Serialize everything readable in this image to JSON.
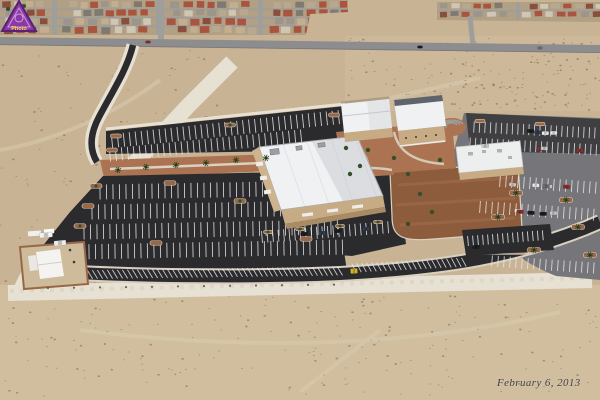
{
  "image_type": "oblique-aerial-photograph",
  "watermark": {
    "label": "Photo",
    "triangle_fill": "#8a3aa5",
    "triangle_edge": "#5a2172",
    "inner_ring": "#d9b0e8",
    "text_color": "#ffd84a"
  },
  "caption": {
    "date_text": "February 6, 2013",
    "color": "#3f3f49"
  },
  "palette": {
    "desert": "#c8b394",
    "desert_light": "#d6c4a5",
    "residential_base": "#b2a084",
    "street": "#9e9e9c",
    "road": "#8d8d90",
    "road_edge": "#6e6e71",
    "asphalt_new": "#2b2b2e",
    "asphalt_old": "#76767a",
    "asphalt_north": "#3f3f42",
    "gravel": "#e7e1d3",
    "gravel_inner": "#d8d0c0",
    "dirt_field": "#8d5c3d",
    "dirt_field_light": "#9d6a4a",
    "courtyard": "#ab7351",
    "roof_white": "#f0f1f3",
    "roof_shade": "#dcdde0",
    "wall_tan": "#c6ab85",
    "wall_tan_dark": "#a98c66",
    "curb": "#d9d2c3",
    "island": "#9b6847",
    "stripe": "#e9e9ea",
    "notch_stripe": "#eef4f6",
    "tree": "#33502b",
    "palm": "#2c451f",
    "shrub": "#49583b",
    "speckle": "#6f5e46",
    "track": "#d9cdb2"
  },
  "generator": {
    "seed": 7,
    "house_palette": [
      "#a8543f",
      "#9b958b",
      "#c3ae90",
      "#8a4f3c",
      "#b7a88f",
      "#d0c6b4",
      "#7e7a72",
      "#a8543f"
    ],
    "car_palette": [
      "#1e1e22",
      "#2e3c55",
      "#6d7076",
      "#c9cacc",
      "#8c2f2b",
      "#e9e9e9",
      "#3c4a3a"
    ],
    "counts": {
      "speckles": 560,
      "east_cars": 10,
      "north_cars": 8
    }
  }
}
